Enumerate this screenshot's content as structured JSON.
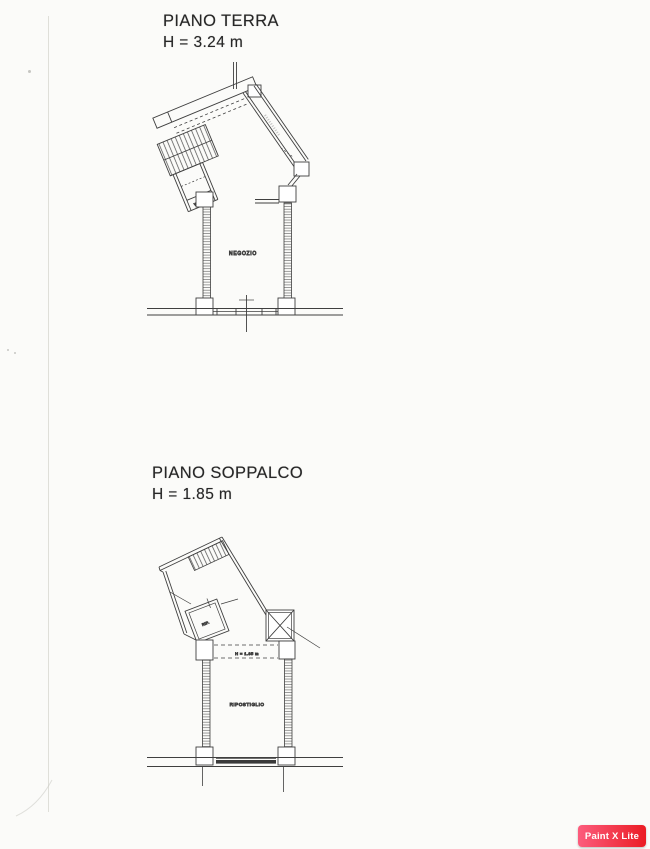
{
  "page": {
    "background": "#fbfbf9",
    "ink": "#3f3f3f"
  },
  "plans": {
    "terra": {
      "title": "PIANO TERRA",
      "height": "H = 3.24 m",
      "room_label": "NEGOZIO",
      "wc_label": "W.C."
    },
    "soppalco": {
      "title": "PIANO SOPPALCO",
      "height": "H = 1.85 m",
      "room_label": "RIPOSTIGLIO",
      "small_room_label": "RIP.",
      "height_line_label": "H = 1.85 m"
    }
  },
  "watermark": {
    "label": "Paint X Lite",
    "gradient_from": "#fc5c7d",
    "gradient_to": "#eb1c24",
    "text_color": "#ffffff"
  }
}
